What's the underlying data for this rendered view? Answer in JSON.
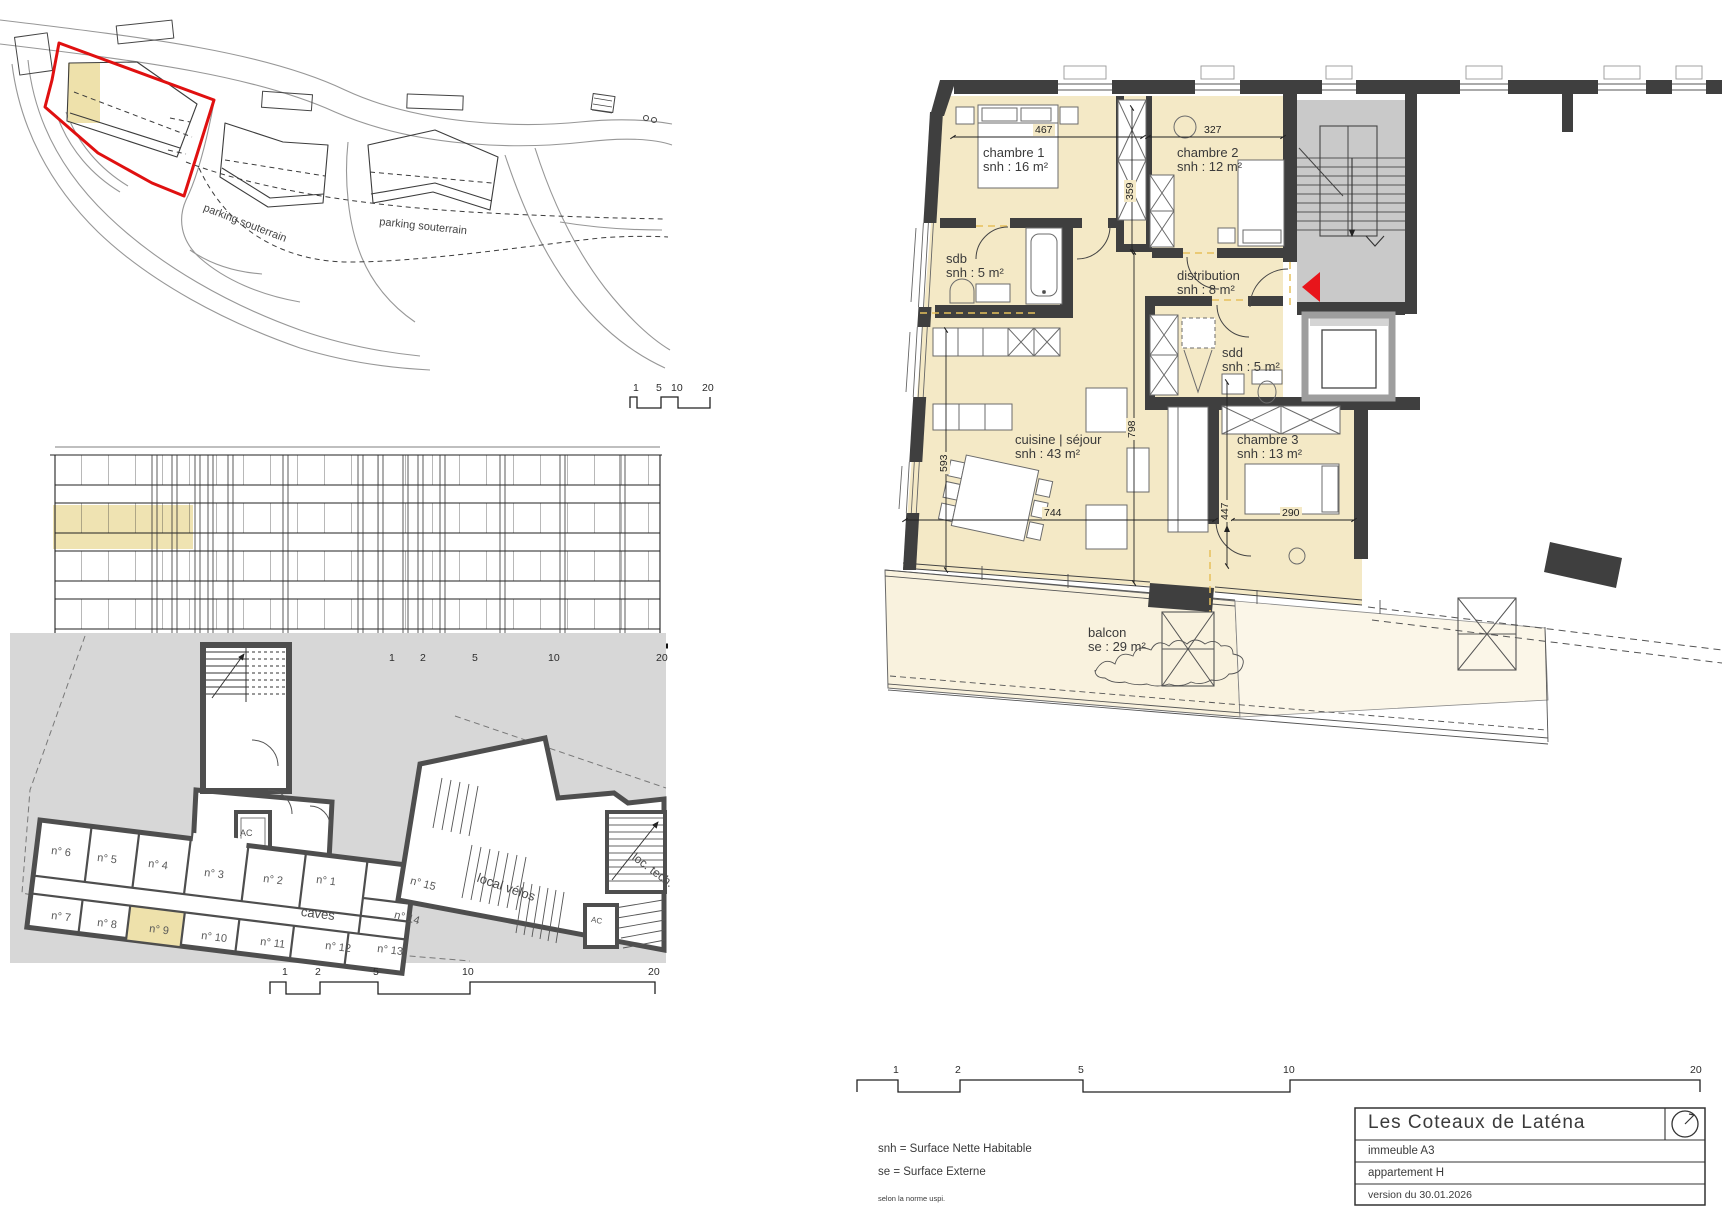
{
  "site": {
    "parking_label_1": "parking souterrain",
    "parking_label_2": "parking souterrain"
  },
  "scalebars": {
    "mini": {
      "labels": [
        "1",
        "5",
        "10",
        "20"
      ]
    },
    "elevation": {
      "labels": [
        "1",
        "2",
        "5",
        "10",
        "20"
      ]
    },
    "basement": {
      "labels": [
        "1",
        "2",
        "5",
        "10",
        "20"
      ]
    },
    "main": {
      "labels": [
        "1",
        "2",
        "5",
        "10",
        "20"
      ]
    }
  },
  "basement": {
    "area_label": "caves",
    "bike_room": "local vélos",
    "tech_room": "loc. tech.",
    "elevator": "AC",
    "elevator2": "AC",
    "cells": [
      "n° 1",
      "n° 2",
      "n° 3",
      "n° 4",
      "n° 5",
      "n° 6",
      "n° 7",
      "n° 8",
      "n° 9",
      "n° 10",
      "n° 11",
      "n° 12",
      "n° 13",
      "n° 14",
      "n° 15"
    ]
  },
  "plan": {
    "rooms": [
      {
        "name": "chambre 1",
        "area": "snh : 16 m²"
      },
      {
        "name": "chambre 2",
        "area": "snh : 12 m²"
      },
      {
        "name": "sdb",
        "area": "snh : 5 m²"
      },
      {
        "name": "distribution",
        "area": "snh : 8 m²"
      },
      {
        "name": "sdd",
        "area": "snh : 5 m²"
      },
      {
        "name": "cuisine | séjour",
        "area": "snh : 43 m²"
      },
      {
        "name": "chambre 3",
        "area": "snh : 13 m²"
      },
      {
        "name": "balcon",
        "area": "se : 29 m²"
      }
    ],
    "dimensions": {
      "d467": "467",
      "d327": "327",
      "d359": "359",
      "d593": "593",
      "d798": "798",
      "d744": "744",
      "d447": "447",
      "d290": "290"
    }
  },
  "legend": {
    "snh": "snh = Surface Nette Habitable",
    "se": "se = Surface Externe",
    "norm": "selon la norme uspi."
  },
  "title_block": {
    "project": "Les Coteaux de Laténa",
    "building": "immeuble A3",
    "apartment": "appartement H",
    "version": "version du 30.01.2026"
  },
  "colors": {
    "room_fill": "#f4e9c6",
    "balcony_fill": "#f9f2de",
    "highlight": "#eee1ab",
    "wall": "#3f3f3f",
    "basement_gray": "#d7d7d7",
    "stair_gray": "#c9c9c9",
    "red_outline": "#e01010",
    "red_arrow": "#e8151b",
    "snh_dashed": "#e6c05c"
  }
}
